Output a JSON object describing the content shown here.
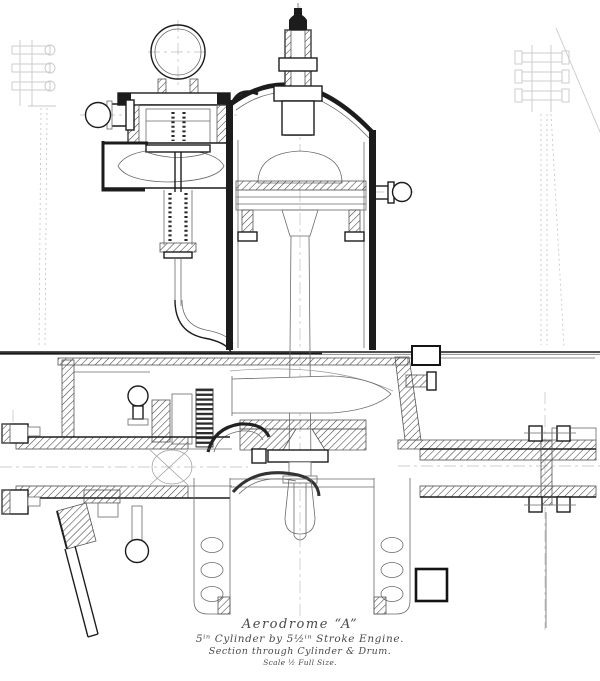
{
  "caption": {
    "title": "Aerodrome “A”",
    "line2": "5ⁱⁿ Cylinder by 5½ⁱⁿ Stroke Engine.",
    "line3": "Section through Cylinder & Drum.",
    "line4": "Scale ½ Full Size."
  },
  "colors": {
    "ink": "#1c1c1c",
    "ghost": "#c9c9c9",
    "paper": "#ffffff",
    "faded": "#4a4a4a"
  }
}
